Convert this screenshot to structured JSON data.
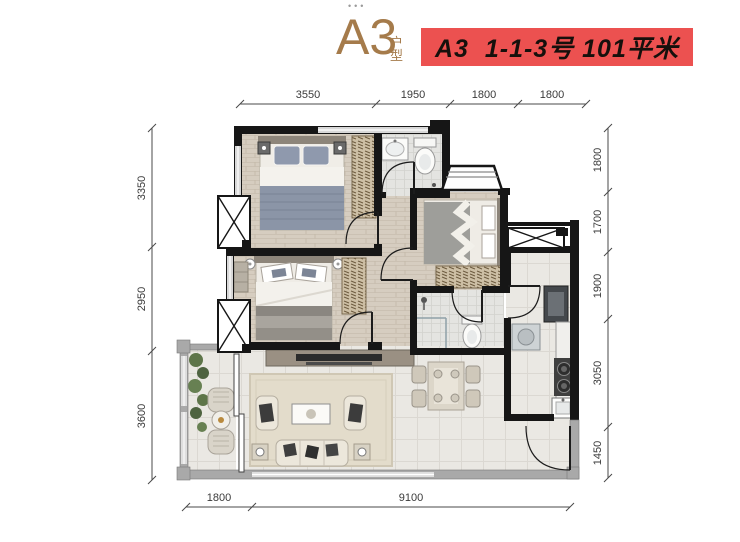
{
  "header": {
    "dots": "•••",
    "title": "A3",
    "title_suffix_top": "户",
    "title_suffix_bottom": "型",
    "badge": "A3  1-1-3号 101平米"
  },
  "dimensions": {
    "top": [
      "3550",
      "1950",
      "1800",
      "1800"
    ],
    "left": [
      "3350",
      "2950",
      "3600"
    ],
    "right": [
      "1800",
      "1700",
      "1900",
      "3050",
      "1450"
    ],
    "bottom": [
      "1800",
      "9100"
    ]
  },
  "colors": {
    "title": "#a57b4b",
    "badge_bg": "#ec5150",
    "badge_text": "#16100c",
    "interior_wall": "#161616",
    "exterior_wall": "#a9a9a9",
    "wood_floor": "#d6cdc0",
    "tile_floor": "#eae8e3",
    "dimension_text": "#3a3a3a",
    "plant_green": "#5e7549"
  },
  "rooms": [
    "master-bedroom",
    "bathroom-1",
    "bedroom-2",
    "bedroom-3",
    "bathroom-2",
    "kitchen",
    "dining-area",
    "living-room",
    "balcony",
    "entry"
  ]
}
